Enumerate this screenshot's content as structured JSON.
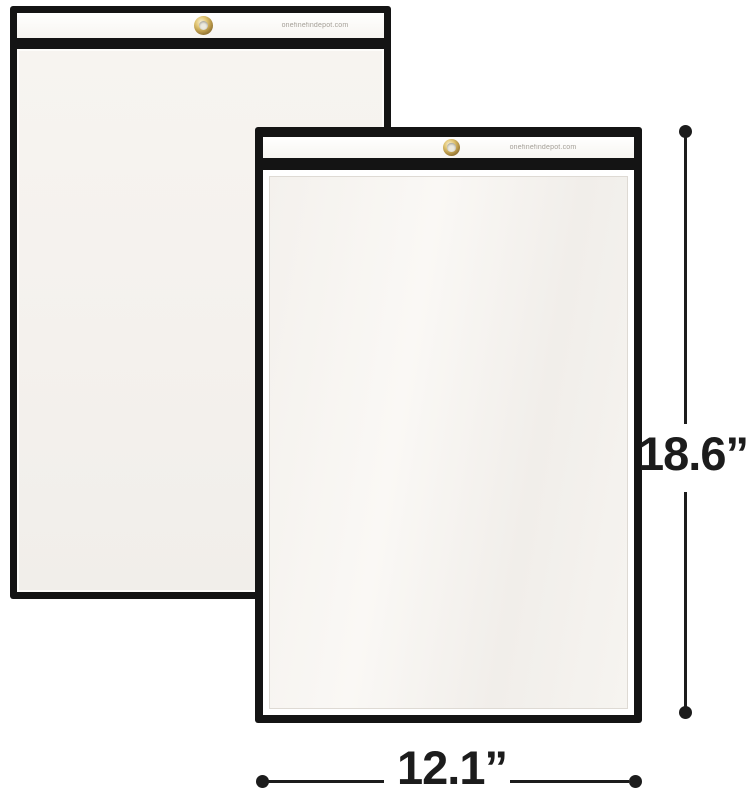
{
  "product": {
    "description": "Two clear shop ticket holders with black sewn edges and brass hanging grommets",
    "back_sleeve": {
      "watermark": "onefinefindepot.com"
    },
    "front_sleeve": {
      "watermark": "onefinefindepot.com"
    }
  },
  "annotations": {
    "height_label": "18.6”",
    "width_label": "12.1”"
  },
  "colors": {
    "background": "#ffffff",
    "sleeve_border_black": "#141414",
    "panel_offwhite": "#f5f3ef",
    "header_white": "#ffffff",
    "grommet_brass": "#bb9a4a",
    "watermark_gray": "#a39e96",
    "annotation_black": "#1c1c1c"
  }
}
